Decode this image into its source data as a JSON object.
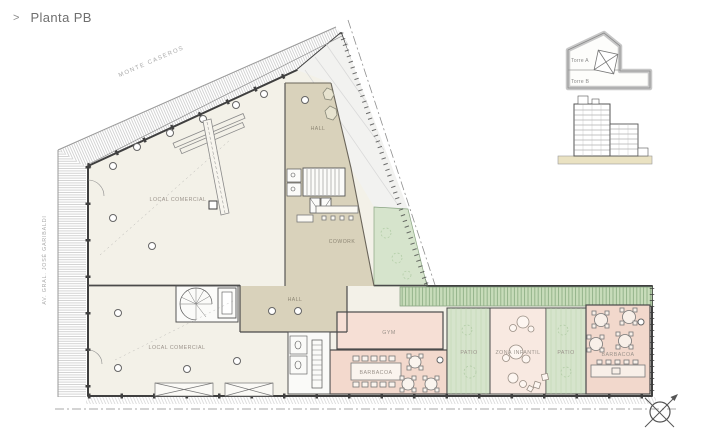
{
  "header": {
    "chevron": ">",
    "title": "Planta PB"
  },
  "streets": {
    "top": "MONTE CASEROS",
    "left": "AV. GRAL. JOSÉ GARIBALDI"
  },
  "rooms": {
    "local_comercial_upper": "LOCAL COMERCIAL",
    "hall_upper": "HALL",
    "cowork": "COWORK",
    "hall_lower": "HALL",
    "local_comercial_lower": "LOCAL COMERCIAL",
    "gym": "GYM",
    "barbacoa_center": "BARBACOA",
    "patio_left": "PATIO",
    "zona_infantil": "ZONA INFANTIL",
    "patio_right": "PATIO",
    "barbacoa_right": "BARBACOA"
  },
  "key_plan": {
    "torre_a": "Torre A",
    "torre_b": "Torre B"
  },
  "icons": {
    "compass_rose": "circle-with-x-and-north-arrow"
  },
  "colors": {
    "floor_cream": "#f3f1e8",
    "hall_beige": "#d9d2bb",
    "patio_green": "#d6e4cc",
    "pergola_green": "#c8dcba",
    "room_pink": "#f3d9cd",
    "room_pink_light": "#f8e9e1",
    "ground_sand": "#eae2c2",
    "wall_line": "#3f3f3f",
    "hatch_gray": "#c6c6c6",
    "label_gray": "#9b938b"
  }
}
